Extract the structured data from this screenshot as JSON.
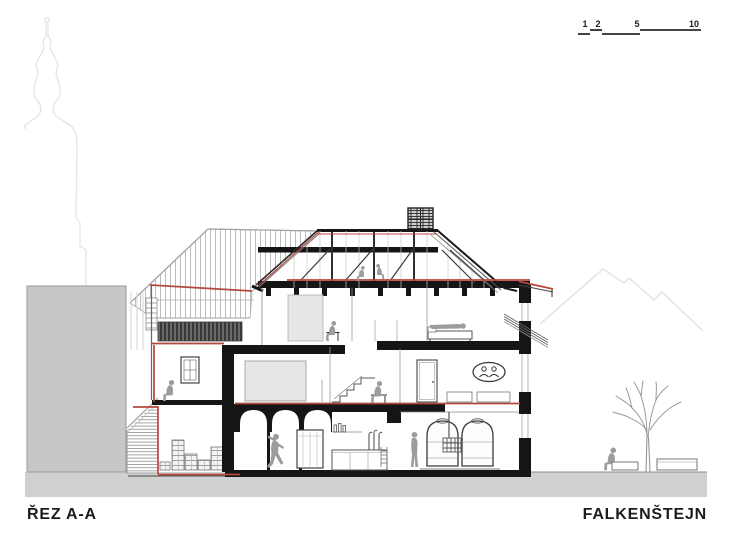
{
  "titles": {
    "section": "ŘEZ A-A",
    "project": "FALKENŠTEJN"
  },
  "scale_bar": {
    "labels": [
      "1",
      "2",
      "5",
      "10"
    ]
  },
  "colors": {
    "section_red": "#b5473c",
    "ink": "#1c1c1c",
    "poche_black": "#151515",
    "mass_gray": "#c7c7c7",
    "ground_gray": "#d0d0d0",
    "people_gray": "#9c9c9c",
    "faint_outline": "#e4e4e4"
  }
}
